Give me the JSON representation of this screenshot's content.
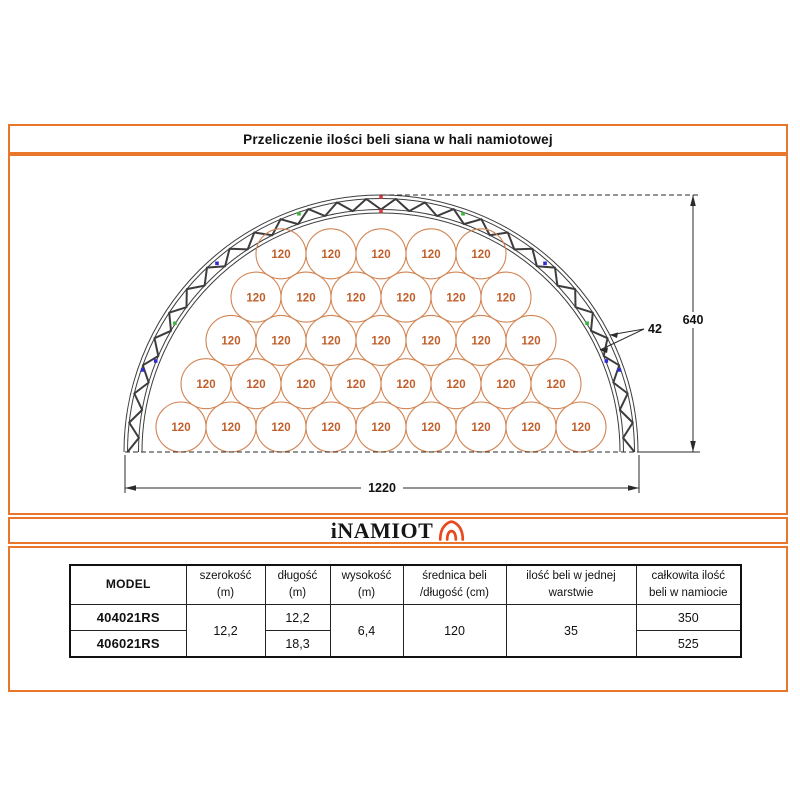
{
  "title": "Przeliczenie ilości beli siana w hali namiotowej",
  "logo": {
    "text": "iNAMIOT",
    "icon": "tent-arch-icon"
  },
  "diagram": {
    "bale_label": "120",
    "bale_rows_bottom_to_top": [
      9,
      8,
      7,
      6,
      5
    ],
    "total_bales_in_layer": 35,
    "dim_width_label": "1220",
    "dim_height_label": "640",
    "dim_truss_label": "42"
  },
  "table": {
    "columns": [
      {
        "title": "MODEL",
        "sub": ""
      },
      {
        "title": "szerokość",
        "sub": "(m)"
      },
      {
        "title": "długość",
        "sub": "(m)"
      },
      {
        "title": "wysokość",
        "sub": "(m)"
      },
      {
        "title": "średnica beli",
        "sub": "/długość (cm)"
      },
      {
        "title": "ilość beli w jednej",
        "sub": "warstwie"
      },
      {
        "title": "całkowita ilość",
        "sub": "beli w namiocie"
      }
    ],
    "shared": {
      "szerokosc": "12,2",
      "wysokosc": "6,4",
      "srednica": "120",
      "ilosc_warstwa": "35"
    },
    "models": [
      {
        "model": "404021RS",
        "dlugosc": "12,2",
        "calkowita": "350"
      },
      {
        "model": "406021RS",
        "dlugosc": "18,3",
        "calkowita": "525"
      }
    ]
  },
  "colors": {
    "frame_orange": "#E8762B",
    "logo_orange": "#E8491D",
    "bale_stroke": "#D28553",
    "bale_text": "#C05F2B",
    "truss_gray": "#3D3D3D",
    "dim_line": "#2A2A2A",
    "marker_red": "#D93A3A",
    "marker_green": "#3CB23C",
    "marker_blue": "#2B2BD9"
  }
}
